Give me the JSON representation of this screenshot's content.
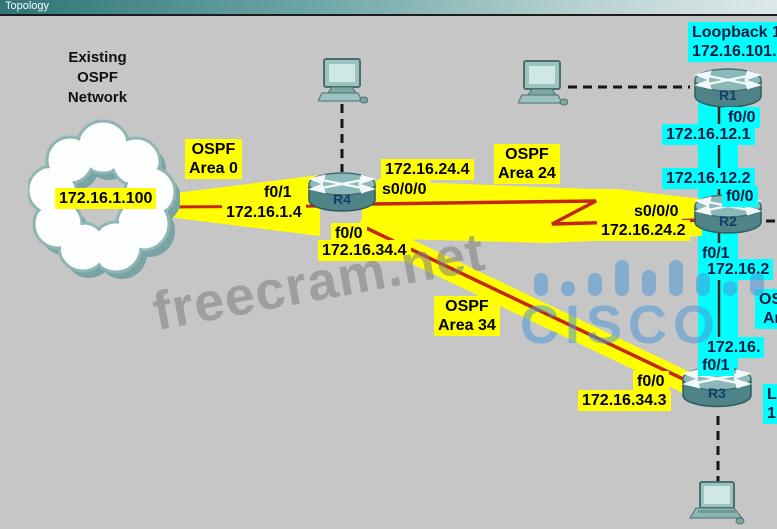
{
  "title_bar": {
    "title": "Topology"
  },
  "cloud": {
    "caption_line1": "Existing",
    "caption_line2": "OSPF",
    "caption_line3": "Network",
    "address": "172.16.1.100"
  },
  "areas": {
    "area0": {
      "line1": "OSPF",
      "line2": "Area 0"
    },
    "area24": {
      "line1": "OSPF",
      "line2": "Area 24"
    },
    "area34": {
      "line1": "OSPF",
      "line2": "Area 34"
    },
    "area_edge_clipped": {
      "line1": "OSPF",
      "line2": "Area"
    }
  },
  "routers": {
    "r1": {
      "name": "R1"
    },
    "r2": {
      "name": "R2"
    },
    "r3": {
      "name": "R3"
    },
    "r4": {
      "name": "R4"
    }
  },
  "interfaces": {
    "r4": {
      "f0_1": "f0/1",
      "f0_1_ip": "172.16.1.4",
      "s0_0_0_ip": "172.16.24.4",
      "s0_0_0": "s0/0/0",
      "f0_0": "f0/0",
      "f0_0_ip": "172.16.34.4"
    },
    "r1": {
      "loopback": "Loopback 10",
      "loopback_ip": "172.16.101.1",
      "f0_0": "f0/0",
      "f0_0_ip": "172.16.12.1"
    },
    "r2": {
      "s0_0_0": "s0/0/0",
      "s0_0_0_ip": "172.16.24.2",
      "f0_0_ip": "172.16.12.2",
      "f0_0": "f0/0",
      "f0_1": "f0/1",
      "f0_1_ip": "172.16.2"
    },
    "r3": {
      "f0_0": "f0/0",
      "f0_0_ip": "172.16.34.3",
      "f0_1_ip": "172.16.",
      "f0_1": "f0/1",
      "edge_clipped_line1": "L",
      "edge_clipped_line2": "1"
    }
  },
  "watermarks": {
    "site": "freecram.net",
    "brand": "CISCO"
  },
  "colors": {
    "label_yellow": "#ffff00",
    "label_cyan": "#00ffff",
    "link_red": "#c42718",
    "background": "#c6c6c6",
    "titlebar_teal": "#2f7476",
    "watermark_blue": "#4e97d8",
    "watermark_gray": "#7e7e7e"
  }
}
